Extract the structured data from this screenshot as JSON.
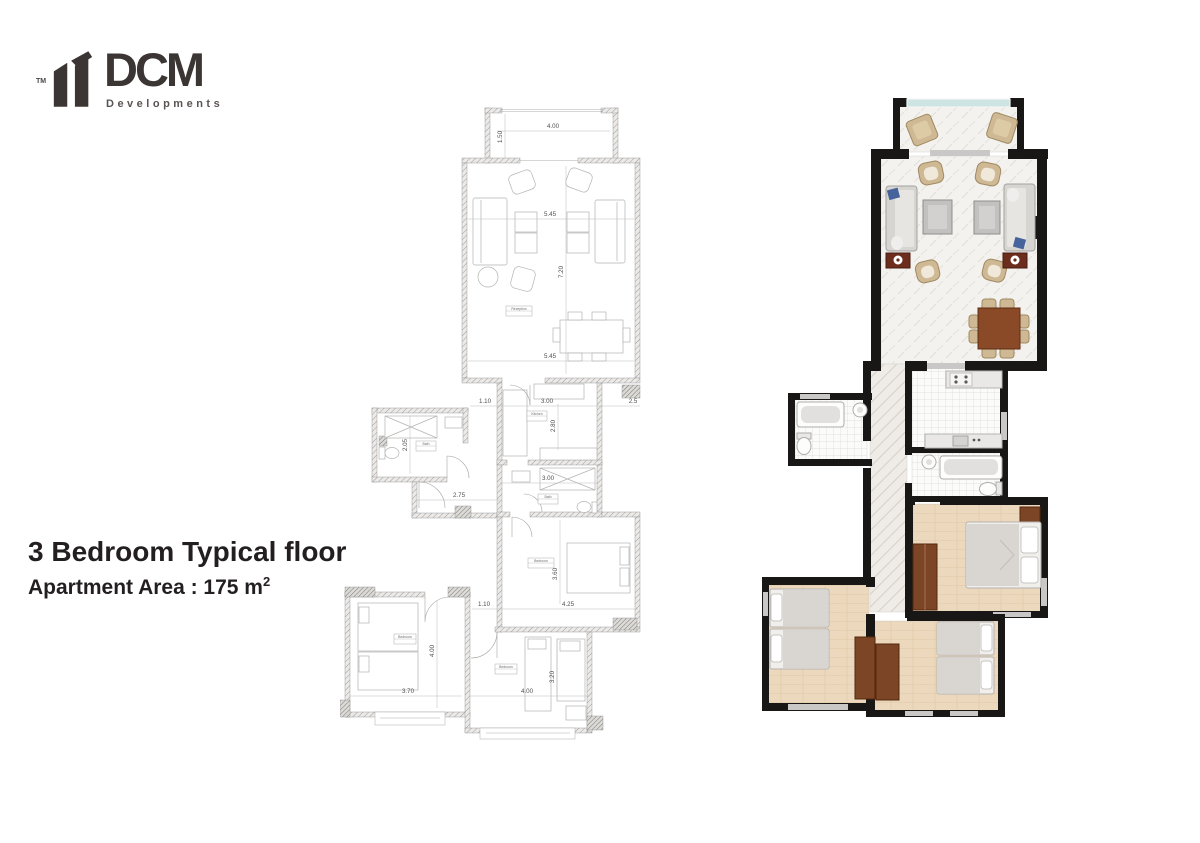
{
  "logo": {
    "tm": "TM",
    "name": "DCM",
    "subtitle": "Developments",
    "brand_color": "#3b3634"
  },
  "title": {
    "line1": "3 Bedroom Typical floor",
    "area_label": "Apartment  Area :",
    "area_value": "  175 m",
    "area_sup": "2"
  },
  "technical_plan": {
    "dims": {
      "balcony_width": "4.00",
      "balcony_depth": "1.50",
      "reception_width_top": "5.45",
      "reception_depth": "7.20",
      "reception_width_bottom": "5.45",
      "hall_width": "1.10",
      "kitchen_width": "3.00",
      "right_offset": "2.5",
      "kitchen_depth": "2.80",
      "bath1_depth": "2.05",
      "bath2_width": "3.00",
      "corridor_width": "2.75",
      "master_depth": "3.60",
      "hall2_width": "1.10",
      "master_width": "4.25",
      "bedroom2_depth": "4.00",
      "bedroom2_width": "3.70",
      "bedroom3_depth": "3.20",
      "bedroom3_width": "4.00"
    },
    "labels": {
      "reception": "Reception",
      "kitchen": "Kitchen",
      "bath1": "Bath",
      "bath2": "Bath",
      "master": "Bedroom",
      "bedroom2": "Bedroom",
      "bedroom3": "Bedroom"
    }
  },
  "rendered_plan": {
    "colors": {
      "wall": "#191715",
      "wood_floor": "#ecd9bd",
      "tile_floor": "#fbfbfa",
      "marble_floor": "#f4f2ef",
      "sofa": "#d6d5d2",
      "pillow_blue": "#46639b",
      "armchair_tan": "#cfb894",
      "table_brown": "#8a4a28",
      "side_table_red": "#6c2d1c",
      "wardrobe_brown": "#7c4526",
      "window_glass": "#cde4e2"
    }
  }
}
